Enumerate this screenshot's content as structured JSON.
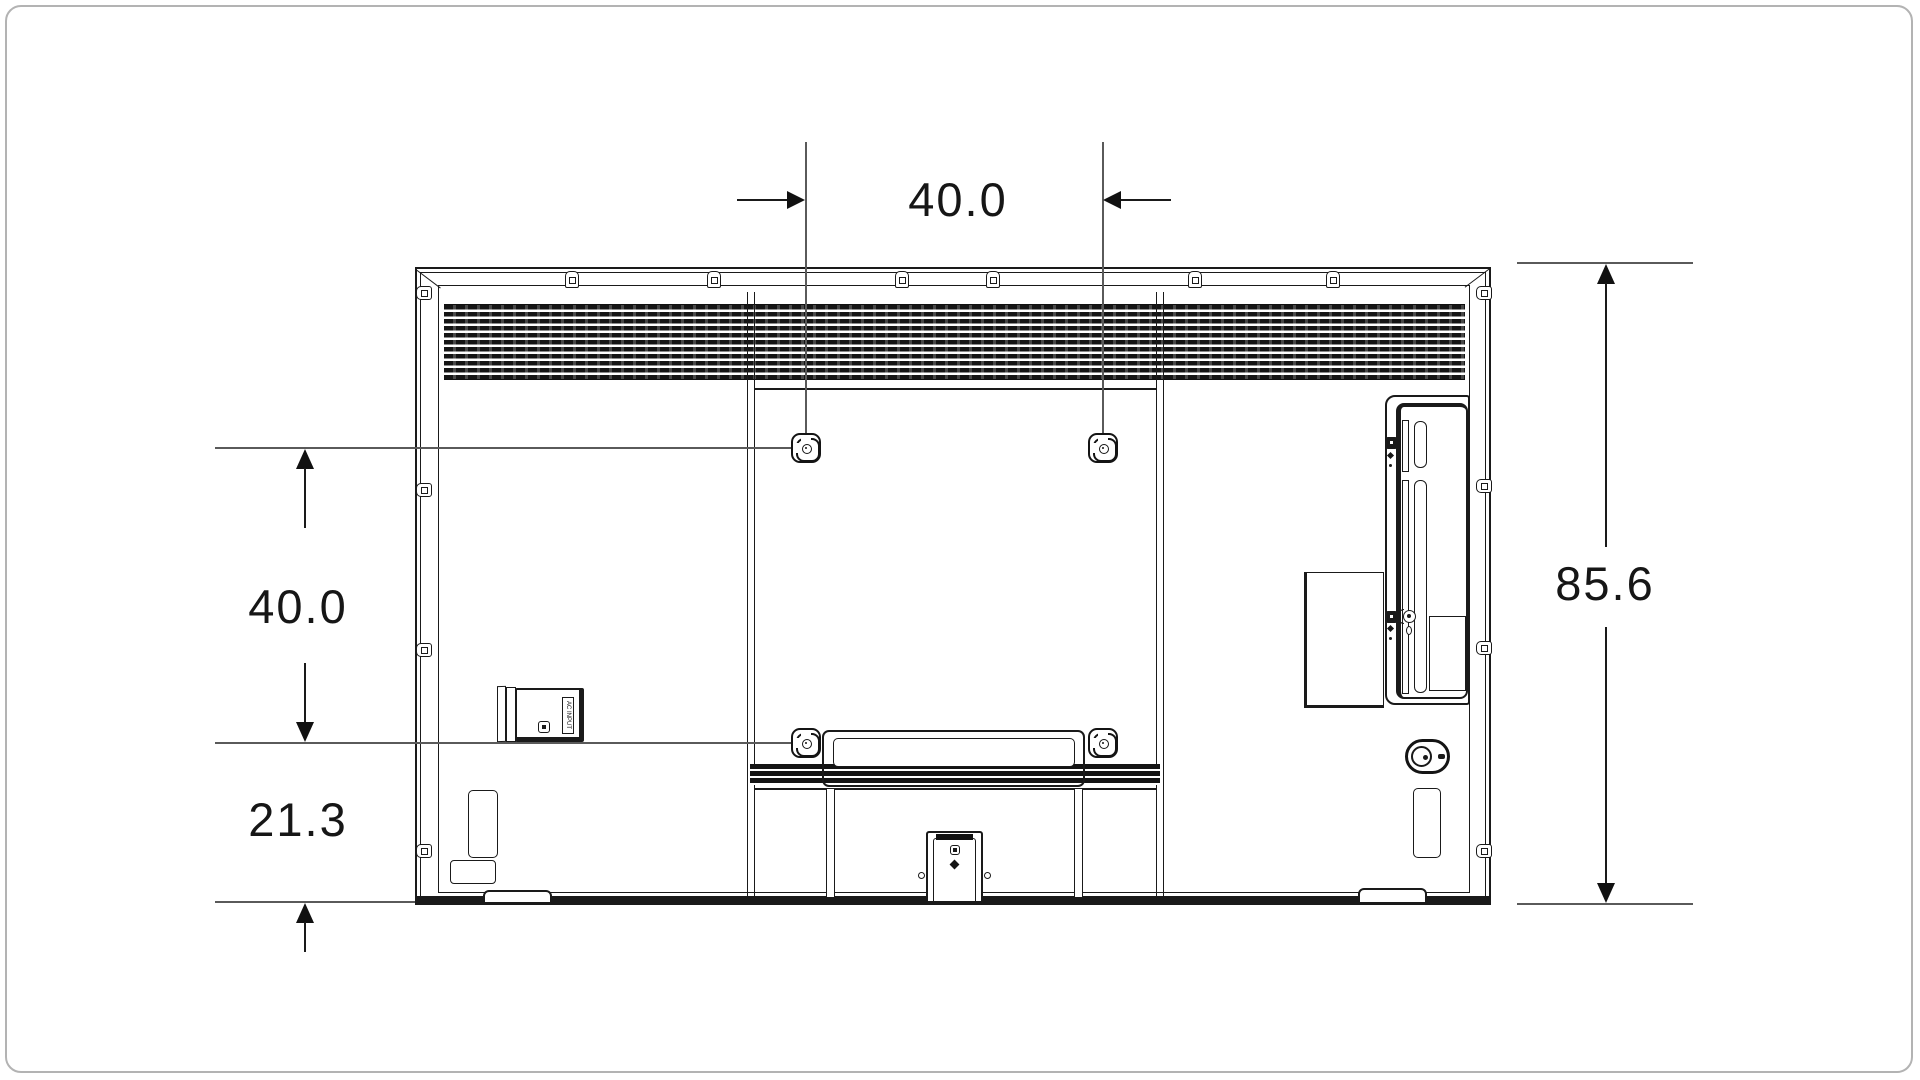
{
  "meta": {
    "description": "Rear-view dimensional line drawing of a flat-panel TV showing VESA wall-mount hole spacing and cabinet dimensions"
  },
  "dimensions": {
    "mount_width": "40.0",
    "mount_height": "40.0",
    "mount_bottom_offset": "21.3",
    "panel_height": "85.6"
  },
  "labels": {
    "ac_inlet": "AC INPUT"
  },
  "icons": {
    "vesa_mount_hole": "rounded-square boss with center screw",
    "top_clip": "mounting clip tab",
    "power_connector": "oval power inlet"
  },
  "colors": {
    "line": "#1a1a1a",
    "dim_line": "#5a5a5a",
    "vent_fill": "#151515",
    "frame_border": "#b3b3b3",
    "background": "#ffffff"
  }
}
